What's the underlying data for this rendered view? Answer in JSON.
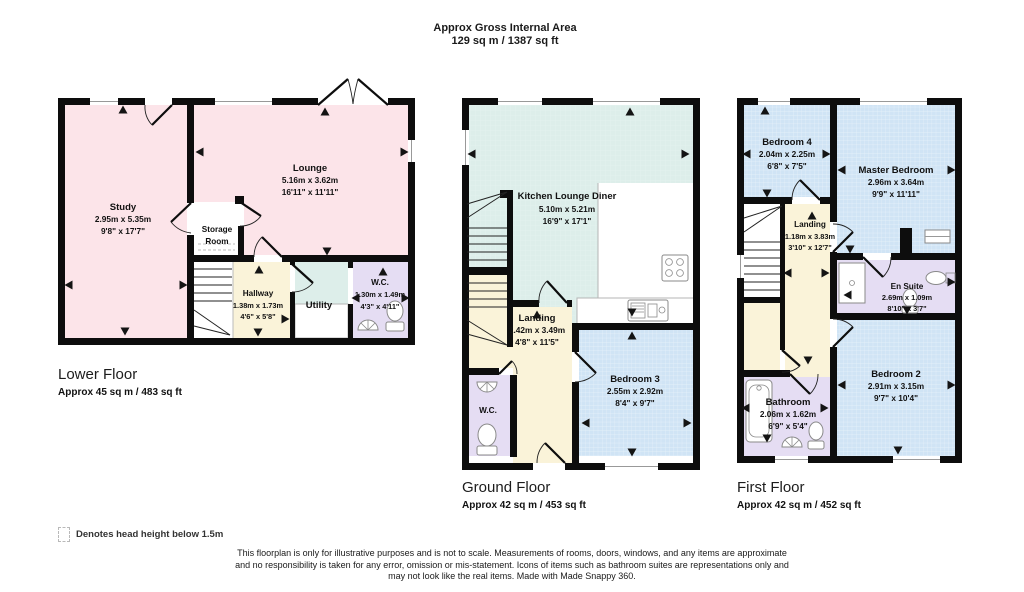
{
  "header": {
    "title": "Approx Gross Internal Area",
    "subtitle": "129 sq m / 1387 sq ft"
  },
  "colors": {
    "wall": "#0d0d0d",
    "room_pink": "#fce4e9",
    "room_green": "#ddeeea",
    "room_blue": "#d0e4f5",
    "room_cream": "#faf3d9",
    "room_purple": "#e5ddf3"
  },
  "floors": {
    "lower": {
      "caption": "Lower Floor",
      "area": "Approx 45 sq m / 483 sq ft",
      "rooms": {
        "study": {
          "name": "Study",
          "metric": "2.95m x 5.35m",
          "imperial": "9'8\" x 17'7\""
        },
        "lounge": {
          "name": "Lounge",
          "metric": "5.16m x 3.62m",
          "imperial": "16'11\" x 11'11\""
        },
        "storage": {
          "line1": "Storage",
          "line2": "Room"
        },
        "hallway": {
          "name": "Hallway",
          "metric": "1.38m x 1.73m",
          "imperial": "4'6\" x 5'8\""
        },
        "utility": {
          "name": "Utility"
        },
        "wc": {
          "name": "W.C.",
          "metric": "1.30m x 1.49m",
          "imperial": "4'3\" x 4'11\""
        }
      }
    },
    "ground": {
      "caption": "Ground Floor",
      "area": "Approx 42 sq m / 453 sq ft",
      "rooms": {
        "kitchen": {
          "name": "Kitchen Lounge Diner",
          "metric": "5.10m x 5.21m",
          "imperial": "16'9\" x 17'1\""
        },
        "landing": {
          "name": "Landing",
          "metric": "1.42m x 3.49m",
          "imperial": "4'8\" x 11'5\""
        },
        "wc": {
          "name": "W.C."
        },
        "bedroom3": {
          "name": "Bedroom 3",
          "metric": "2.55m x 2.92m",
          "imperial": "8'4\" x 9'7\""
        }
      }
    },
    "first": {
      "caption": "First Floor",
      "area": "Approx 42 sq m / 452 sq ft",
      "rooms": {
        "bedroom4": {
          "name": "Bedroom 4",
          "metric": "2.04m x 2.25m",
          "imperial": "6'8\" x 7'5\""
        },
        "master": {
          "name": "Master Bedroom",
          "metric": "2.96m x 3.64m",
          "imperial": "9'9\" x 11'11\""
        },
        "landing": {
          "name": "Landing",
          "metric": "1.18m x 3.83m",
          "imperial": "3'10\" x 12'7\""
        },
        "ensuite": {
          "name": "En Suite",
          "metric": "2.69m x 1.09m",
          "imperial": "8'10\" x 3'7\""
        },
        "bedroom2": {
          "name": "Bedroom 2",
          "metric": "2.91m x 3.15m",
          "imperial": "9'7\" x 10'4\""
        },
        "bathroom": {
          "name": "Bathroom",
          "metric": "2.06m x 1.62m",
          "imperial": "6'9\" x 5'4\""
        }
      }
    }
  },
  "legend": {
    "text": "Denotes head height below 1.5m"
  },
  "disclaimer": {
    "line1": "This floorplan is only for illustrative purposes and is not to scale. Measurements of rooms, doors, windows, and any items are approximate",
    "line2": "and no responsibility is taken for any error, omission or mis-statement. Icons of items such as bathroom suites are representations only and",
    "line3": "may not look like the real items. Made with Made Snappy 360."
  }
}
